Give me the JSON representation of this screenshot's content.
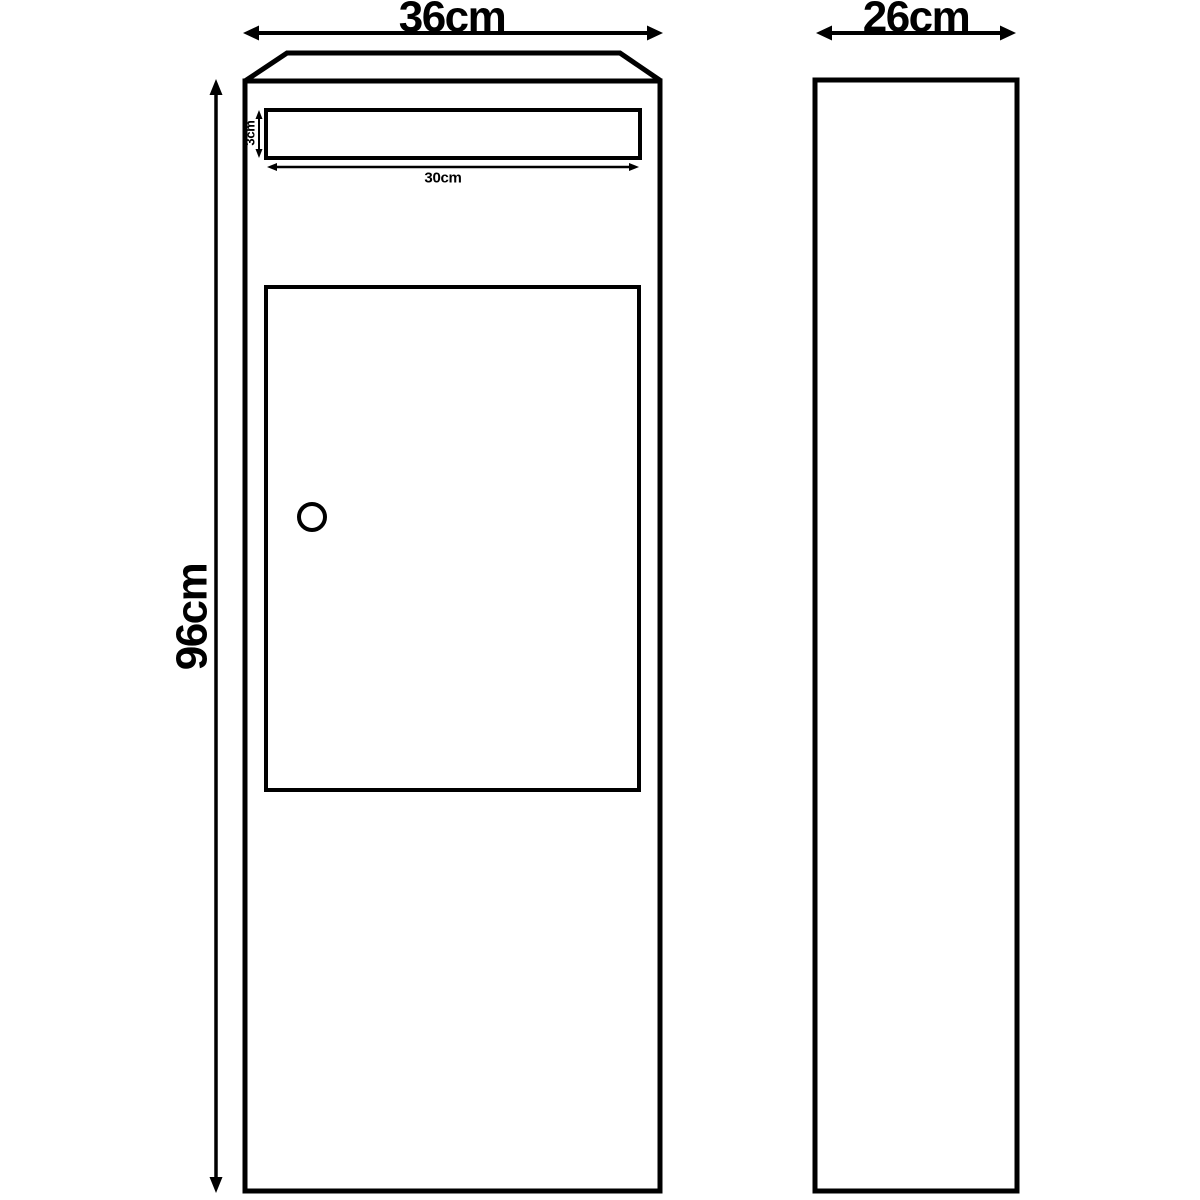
{
  "colors": {
    "line": "#000000",
    "background": "#ffffff"
  },
  "front_view": {
    "width_label": "36cm",
    "height_label": "96cm",
    "slot_width_label": "30cm",
    "slot_height_label": "3cm"
  },
  "side_view": {
    "depth_label": "26cm"
  }
}
